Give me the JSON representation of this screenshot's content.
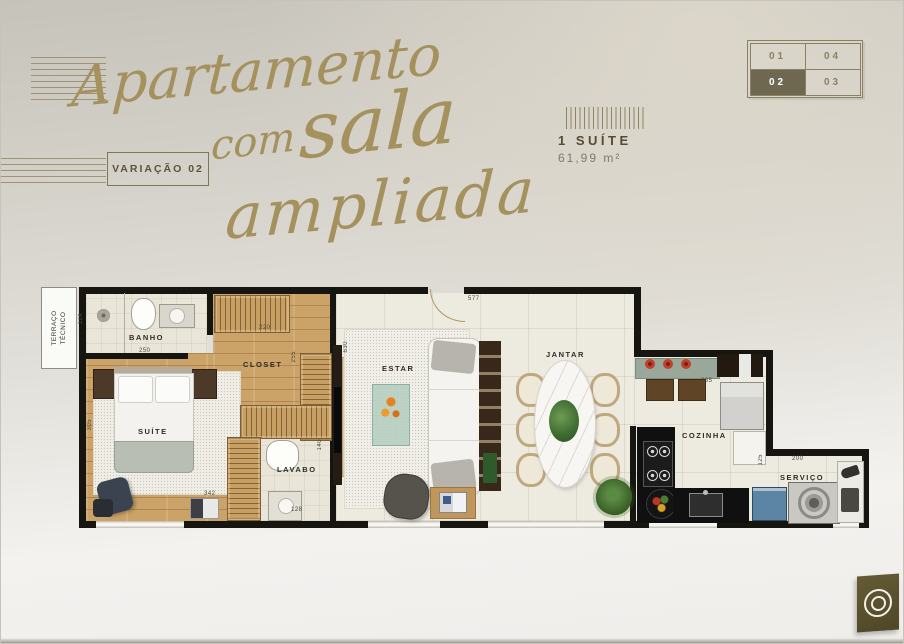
{
  "header": {
    "title": [
      "Apartamento",
      "com",
      "sala",
      "ampliada"
    ],
    "variation": "VARIAÇÃO 02",
    "unit": {
      "type": "1 SUÍTE",
      "area": "61,99 m²"
    },
    "selector": [
      {
        "label": "01",
        "active": false
      },
      {
        "label": "04",
        "active": false
      },
      {
        "label": "02",
        "active": true
      },
      {
        "label": "03",
        "active": false
      }
    ]
  },
  "plan": {
    "rooms": {
      "terraco": "TERRAÇO TÉCNICO",
      "banho": "BANHO",
      "suite": "SUÍTE",
      "closet": "CLOSET",
      "lavabo": "LAVABO",
      "estar": "ESTAR",
      "jantar": "JANTAR",
      "cozinha": "COZINHA",
      "servico": "SERVIÇO"
    },
    "dims": {
      "banho_height": "124",
      "banho_width": "250",
      "suite_height": "305",
      "suite_width": "342",
      "closet_width": "220",
      "closet_height": "255",
      "lavabo_height": "140",
      "lavabo_width": "128",
      "estar_height": "630",
      "estar_width": "577",
      "cozinha_width": "235",
      "servico_height": "125",
      "servico_width": "200"
    }
  },
  "colors": {
    "accent_gold": "#a5915e",
    "olive_active": "#6e6850",
    "wall": "#17150f"
  }
}
